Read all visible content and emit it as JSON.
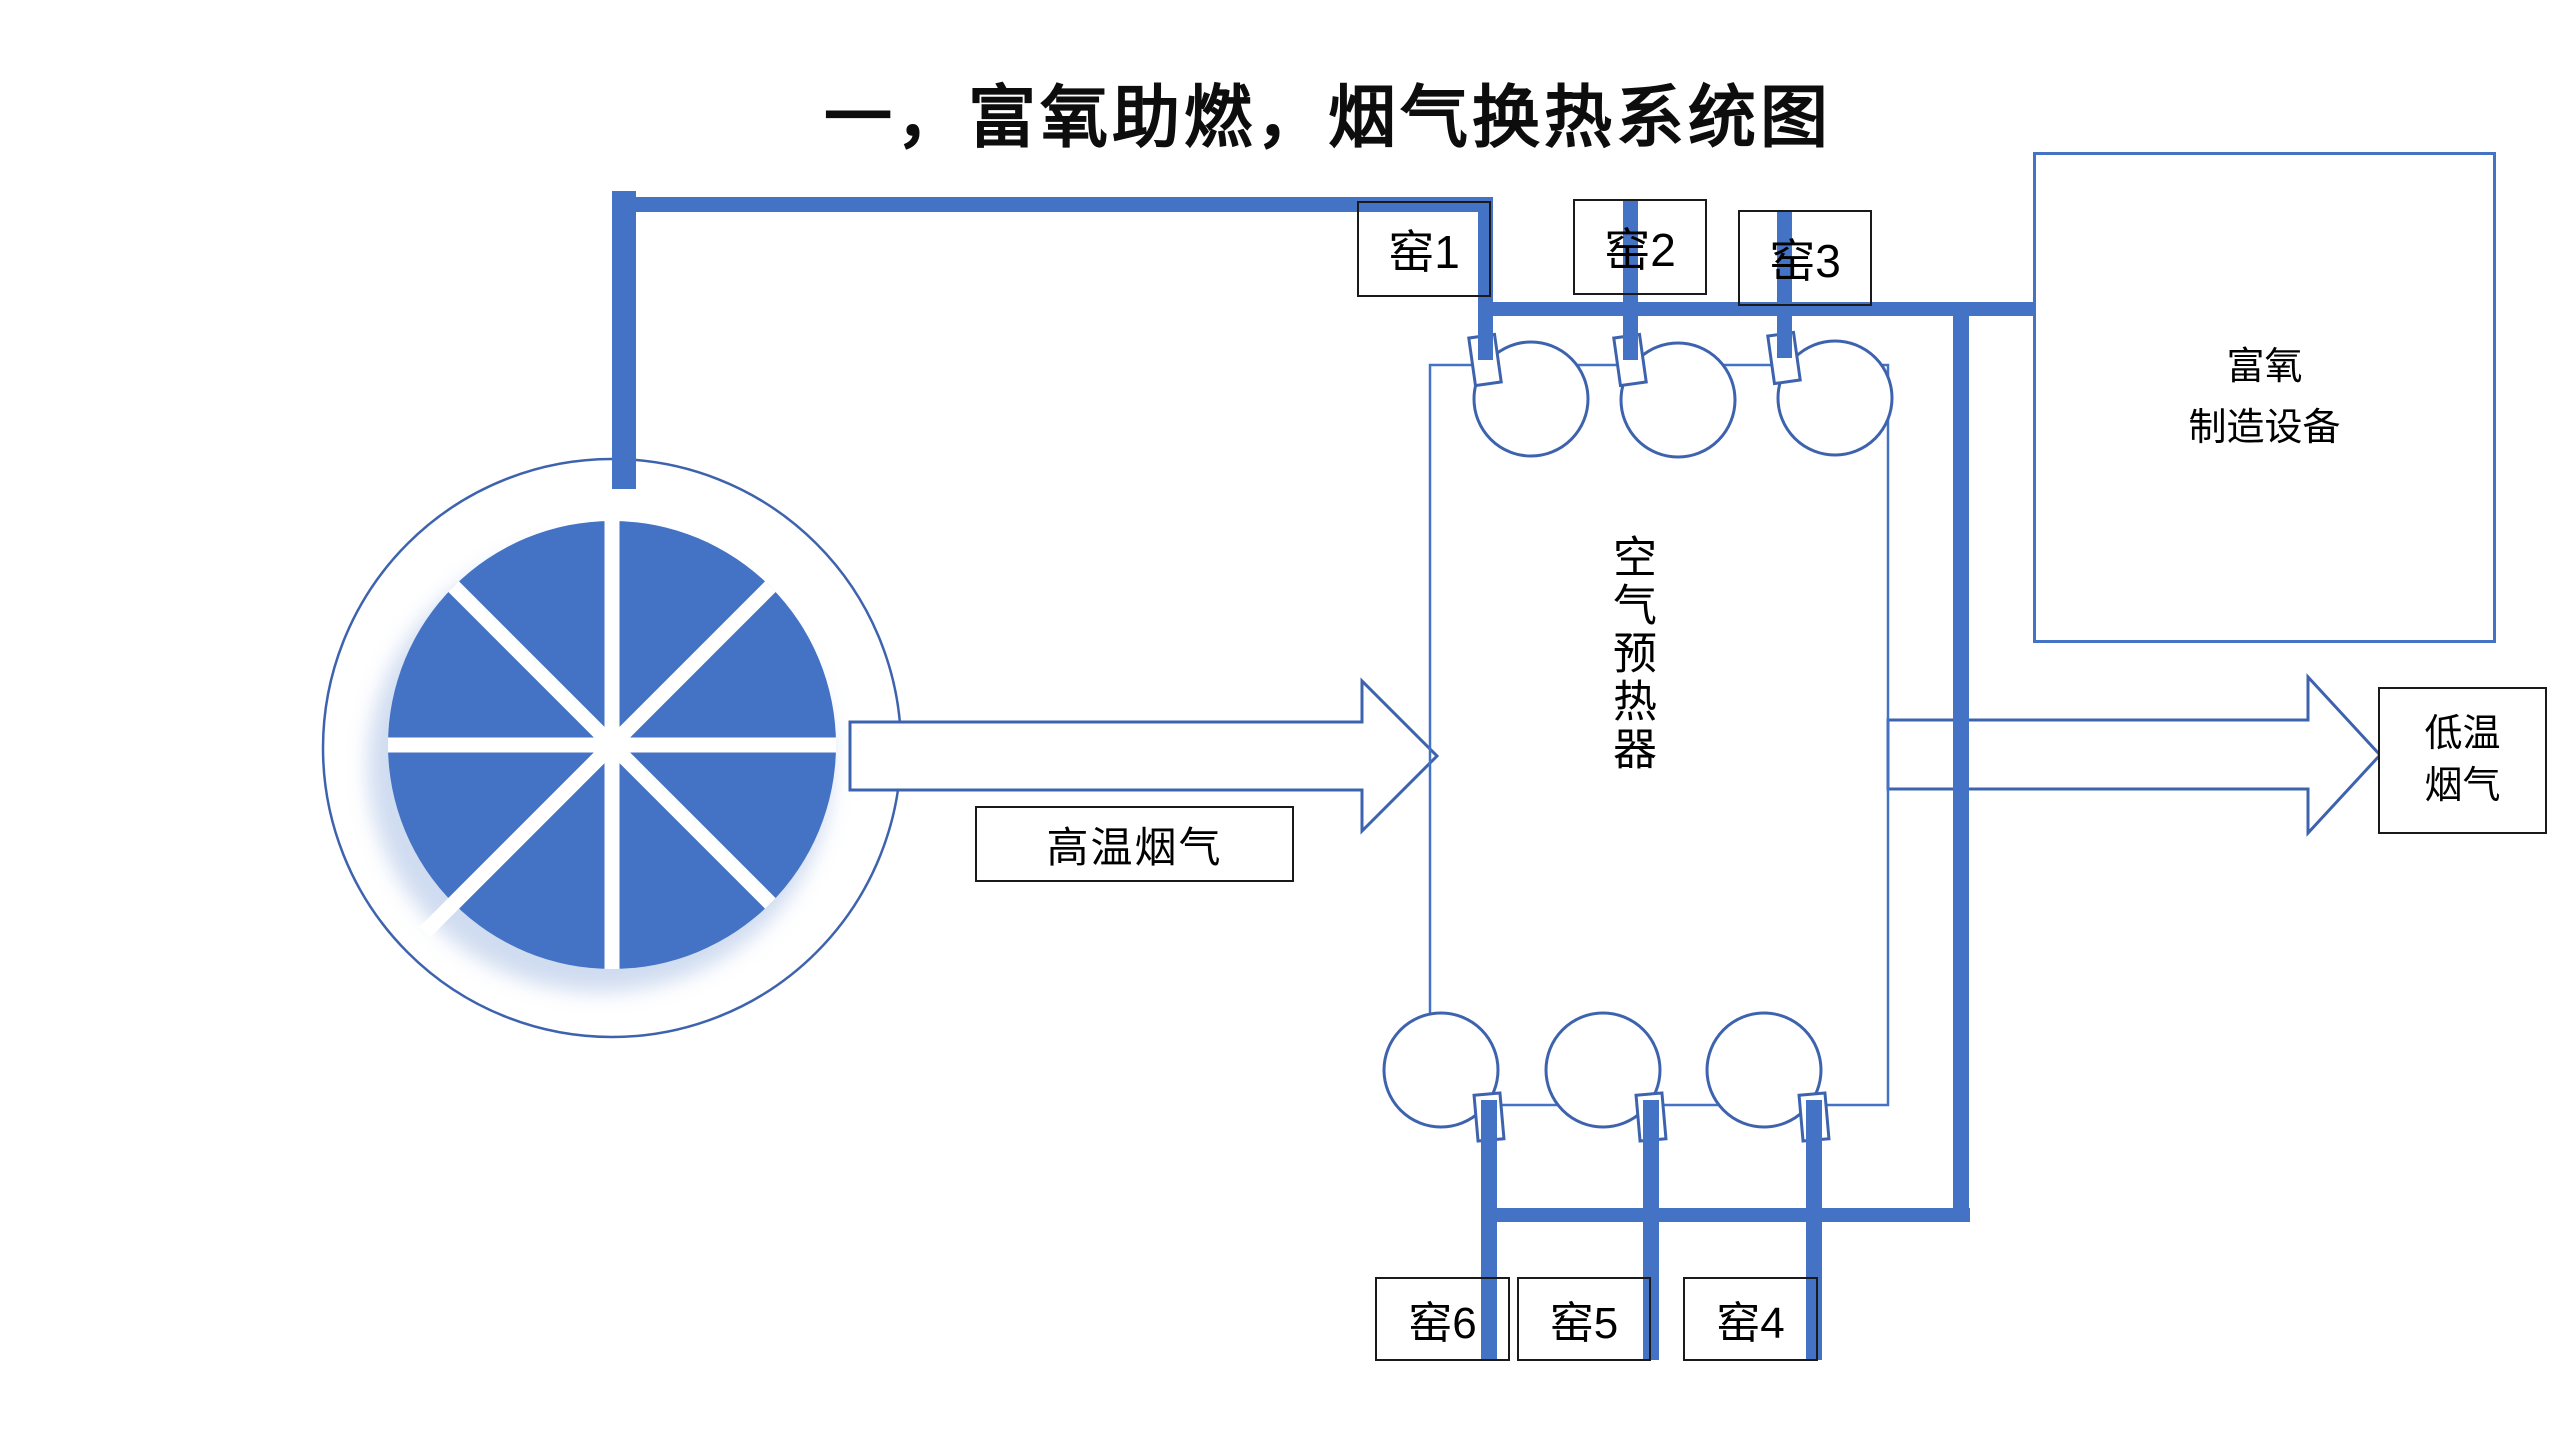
{
  "title": "一，富氧助燃，烟气换热系统图",
  "colors": {
    "pipe": "#4472C4",
    "outline": "#3E63AE",
    "box_border": "#1a1a1a"
  },
  "kilns": {
    "top": [
      {
        "label": "窑1"
      },
      {
        "label": "窑2"
      },
      {
        "label": "窑3"
      }
    ],
    "bottom": [
      {
        "label": "窑6"
      },
      {
        "label": "窑5"
      },
      {
        "label": "窑4"
      }
    ]
  },
  "preheater": {
    "label": "空气预热器"
  },
  "oxygen_unit": {
    "line1": "富氧",
    "line2": "制造设备"
  },
  "arrows": {
    "hot_label": "高温烟气",
    "cold_line1": "低温",
    "cold_line2": "烟气"
  }
}
